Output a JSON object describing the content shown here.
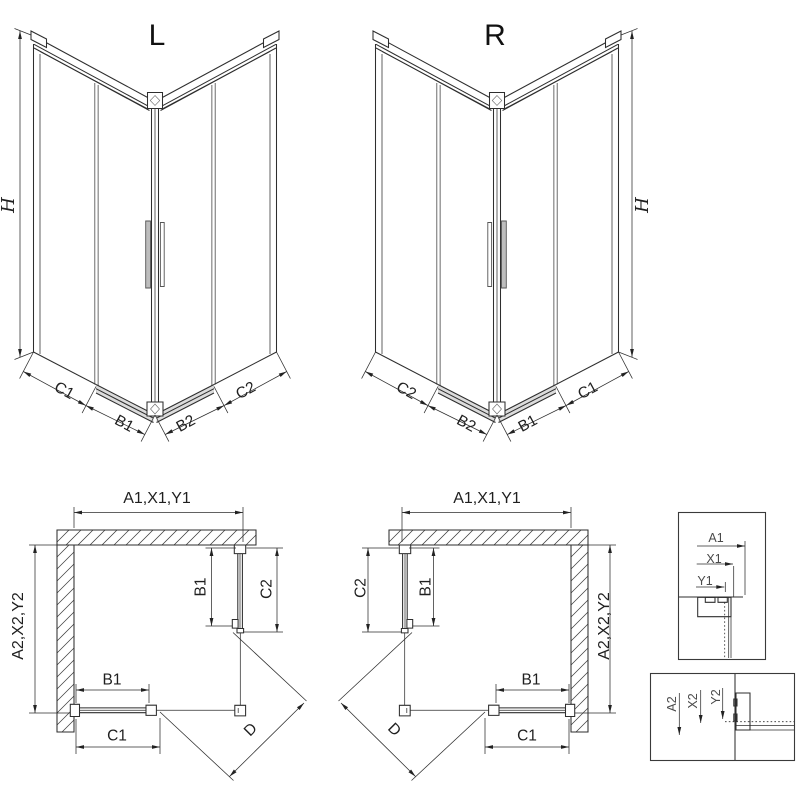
{
  "colors": {
    "line": "#2e2e2e",
    "profile_gray": "#8e8e8e",
    "rail_fill": "#dcdcdc"
  },
  "figure": {
    "view_3d_left": {
      "title": "L",
      "height_label": "H",
      "dims": {
        "c1": "C1",
        "b1": "B1",
        "b2": "B2",
        "c2": "C2"
      }
    },
    "view_3d_right": {
      "title": "R",
      "height_label": "H",
      "dims": {
        "c2": "C2",
        "b2": "B2",
        "b1": "B1",
        "c1": "C1"
      }
    },
    "plan_left": {
      "width_label": "A1,X1,Y1",
      "depth_label": "A2,X2,Y2",
      "side_panel": {
        "b1": "B1",
        "c2": "C2"
      },
      "front_panel": {
        "b1": "B1",
        "c1": "C1"
      },
      "door_label": "D"
    },
    "plan_right": {
      "width_label": "A1,X1,Y1",
      "depth_label": "A2,X2,Y2",
      "side_panel": {
        "b1": "B1",
        "c2": "C2"
      },
      "front_panel": {
        "b1": "B1",
        "c1": "C1"
      },
      "door_label": "D"
    },
    "detail_top": {
      "a1": "A1",
      "x1": "X1",
      "y1": "Y1"
    },
    "detail_bottom": {
      "a2": "A2",
      "x2": "X2",
      "y2": "Y2"
    }
  }
}
